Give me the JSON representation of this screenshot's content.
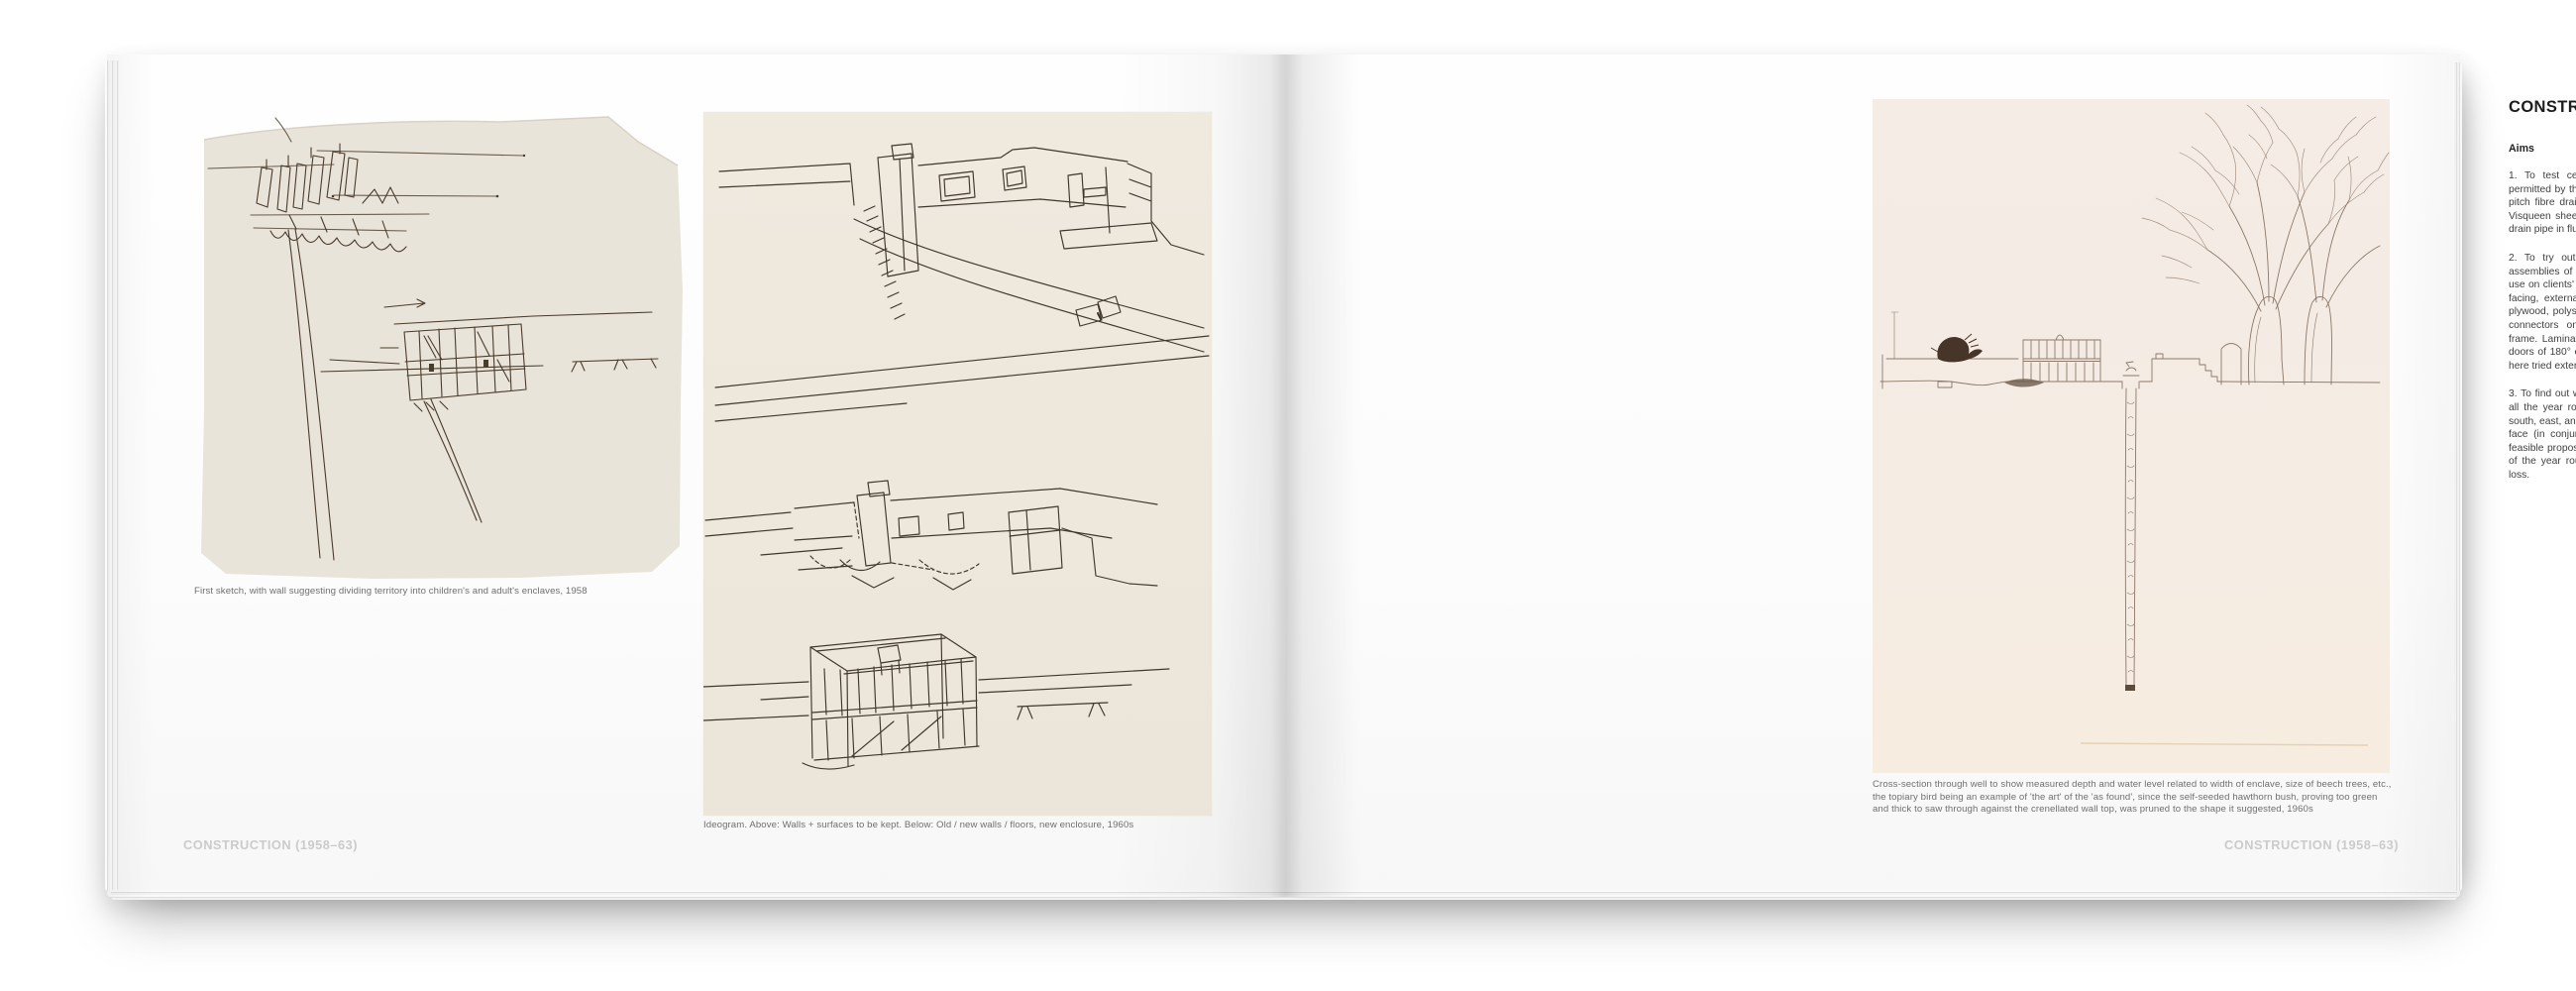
{
  "page_left": {
    "figure1_caption": "First sketch, with wall suggesting dividing territory into children's and adult's enclaves, 1958",
    "figure2_caption": "Ideogram. Above: Walls + surfaces to be kept. Below: Old / new walls / floors, new enclosure, 1960s",
    "footer": "CONSTRUCTION (1958–63)"
  },
  "page_right": {
    "heading": "CONSTRUCTION (1958–63)",
    "subheading": "Aims",
    "paragraphs": [
      "1. To test certain new products which are not yet permitted by the Authorities in the London area. Namely: pitch fibre drainpipes, polythene pipes and bottle traps, Visqueen sheet DPC, polyester water tanks, salt-glazed drain pipe in flue.",
      "2. To try out on ourselves certain applications and assemblies of materials which if successful we will later use on clients' buildings, i.e., high-purity aluminium sheet facing, external and internal doors in aluminium faced plywood, polystyrene insulation to walls and roof, timber connectors on a cantilevered American-type balloon frame. Laminated plank door frames; the sliding folding doors of 180° end fold, normally only for internal use but here tried externally.",
      "3. To find out what it is like to live in a house in England all the year round which presents glass walls to entire south, east, and west, but a solid wall to most of the north face (in conjunction with insulated roof), i.e., if it is a feasible proposition that solar heat can be obtained most of the year round and that its build up can offset heat loss."
    ],
    "figure_caption": "Cross-section through well to show measured depth and water level related to width of enclave, size of beech trees, etc., the topiary bird being an example of 'the art' of the 'as found', since the self-seeded hawthorn bush, proving too green and thick to saw through against the crenellated wall top, was pruned to the shape it suggested, 1960s",
    "footer": "CONSTRUCTION (1958–63)"
  },
  "colors": {
    "sketch_paper": "#e9e4d9",
    "ideogram_paper": "#efe9de",
    "section_paper": "#f4ece5",
    "ink_dark": "#4a3b2b",
    "ink_light": "#8b7868",
    "footer_gray": "#cbcbcb",
    "body_text": "#3f3f3f"
  }
}
